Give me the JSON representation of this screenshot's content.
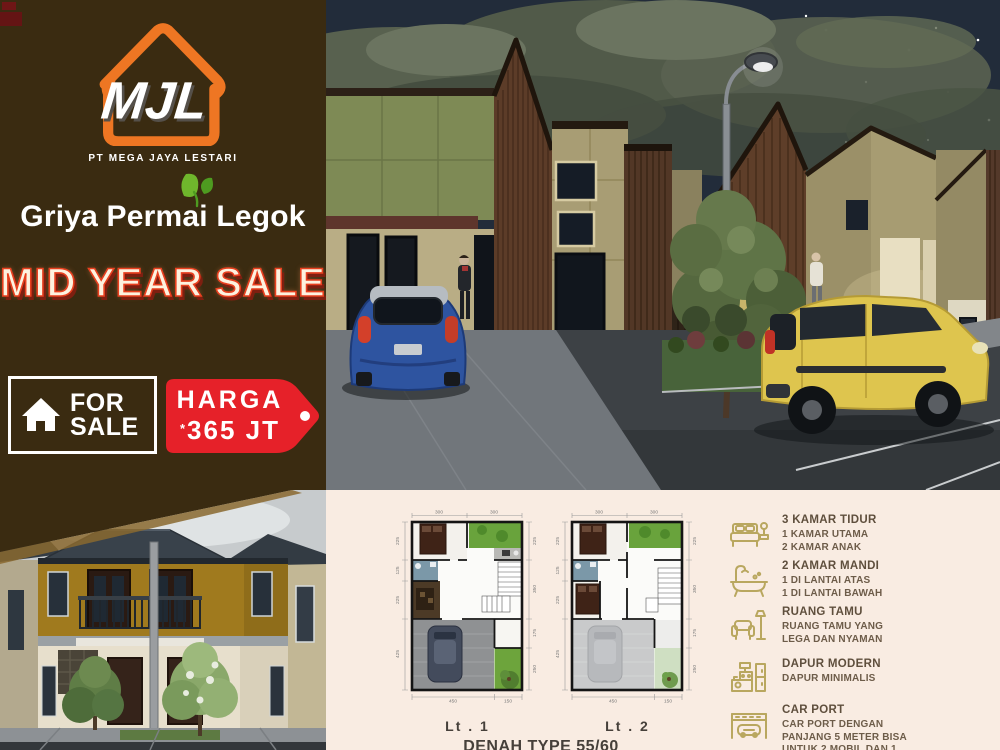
{
  "sidebar": {
    "monogram": "MJL",
    "company": "PT MEGA JAYA LESTARI",
    "project": "Griya Permai Legok",
    "promo": "MID YEAR SALE",
    "for_sale_line1": "FOR",
    "for_sale_line2": "SALE",
    "price_label": "HARGA",
    "price_asterisk": "*",
    "price_value": "365 JT"
  },
  "colors": {
    "sidebar_bg": "#3a2b11",
    "logo_orange": "#ee7623",
    "promo_red": "#e8401f",
    "tag_red": "#e62129",
    "panel_bg": "#f9ece2",
    "icon_olive": "#b9a75f",
    "feature_text": "#6d5c49"
  },
  "floorplans": {
    "caption": "DENAH TYPE 55/60",
    "plan1": {
      "label": "Lt . 1",
      "top": [
        "300",
        "300"
      ],
      "left": [
        "225",
        "125",
        "225",
        "425"
      ],
      "right": [
        "225",
        "350",
        "175",
        "250"
      ],
      "bottom": [
        "450",
        "150"
      ]
    },
    "plan2": {
      "label": "Lt . 2",
      "top": [
        "300",
        "300"
      ],
      "left": [
        "225",
        "125",
        "225",
        "425"
      ],
      "right": [
        "225",
        "350",
        "175",
        "250"
      ],
      "bottom": [
        "450",
        "150"
      ]
    }
  },
  "features": [
    {
      "icon": "bed-icon",
      "title": "3 KAMAR TIDUR",
      "desc": "1 KAMAR UTAMA\n2 KAMAR ANAK"
    },
    {
      "icon": "bathtub-icon",
      "title": "2 KAMAR MANDI",
      "desc": "1 DI LANTAI ATAS\n1 DI LANTAI BAWAH"
    },
    {
      "icon": "sofa-icon",
      "title": "RUANG TAMU",
      "desc": "RUANG TAMU YANG\nLEGA DAN NYAMAN"
    },
    {
      "icon": "kitchen-icon",
      "title": "DAPUR MODERN",
      "desc": "DAPUR MINIMALIS"
    },
    {
      "icon": "carport-icon",
      "title": "CAR PORT",
      "desc": "CAR PORT DENGAN\nPANJANG 5 METER BISA\nUNTUK 2 MOBIL DAN 1\nMOTOR"
    }
  ]
}
